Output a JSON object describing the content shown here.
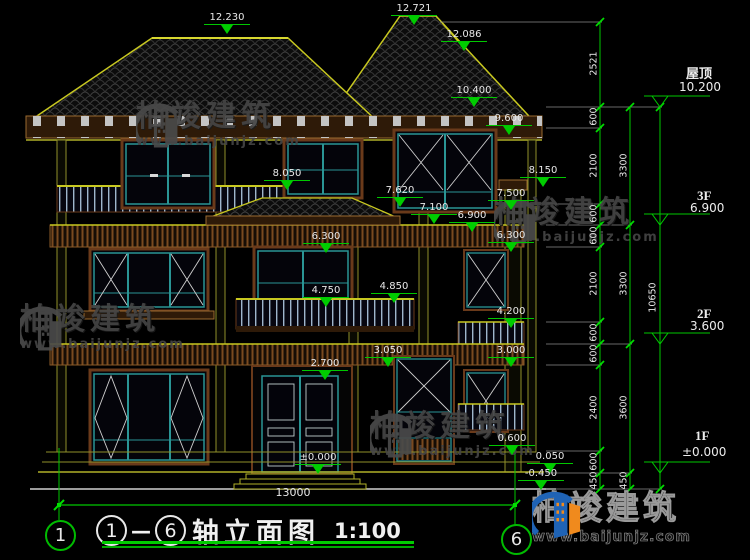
{
  "drawing_title": {
    "axis_from": "1",
    "dash": "—",
    "axis_to": "6",
    "title": "轴立面图",
    "scale": "1:100"
  },
  "axis_bubbles": {
    "left": "1",
    "right": "6"
  },
  "overall_dimension": "13000",
  "watermark": {
    "brand": "柏竣建筑",
    "url": "www.baijunjz.com"
  },
  "logo": {
    "brand": "柏竣建筑",
    "url": "www.baijunjz.com"
  },
  "floor_levels": [
    {
      "name": "屋顶",
      "elevation": "10.200",
      "x": 686,
      "y": 63,
      "ex": 679,
      "ey": 80
    },
    {
      "name": "3F",
      "elevation": "6.900",
      "x": 697,
      "y": 188,
      "ex": 690,
      "ey": 201
    },
    {
      "name": "2F",
      "elevation": "3.600",
      "x": 697,
      "y": 306,
      "ex": 690,
      "ey": 319
    },
    {
      "name": "1F",
      "elevation": "±0.000",
      "x": 695,
      "y": 428,
      "ex": 682,
      "ey": 445
    }
  ],
  "annotations": {
    "elevation_markers": [
      {
        "value": "12.230",
        "x": 204,
        "y": 12
      },
      {
        "value": "12.721",
        "x": 391,
        "y": 3
      },
      {
        "value": "12.086",
        "x": 441,
        "y": 29
      },
      {
        "value": "10.400",
        "x": 451,
        "y": 85
      },
      {
        "value": "9.600",
        "x": 486,
        "y": 113
      },
      {
        "value": "8.050",
        "x": 264,
        "y": 168
      },
      {
        "value": "8.150",
        "x": 520,
        "y": 165
      },
      {
        "value": "7.620",
        "x": 377,
        "y": 185
      },
      {
        "value": "7.500",
        "x": 488,
        "y": 188
      },
      {
        "value": "7.100",
        "x": 411,
        "y": 202
      },
      {
        "value": "6.900",
        "x": 449,
        "y": 210
      },
      {
        "value": "6.300",
        "x": 303,
        "y": 231
      },
      {
        "value": "6.300",
        "x": 488,
        "y": 230
      },
      {
        "value": "4.750",
        "x": 303,
        "y": 285
      },
      {
        "value": "4.850",
        "x": 371,
        "y": 281
      },
      {
        "value": "4.200",
        "x": 488,
        "y": 306
      },
      {
        "value": "3.050",
        "x": 365,
        "y": 345
      },
      {
        "value": "3.000",
        "x": 488,
        "y": 345
      },
      {
        "value": "2.700",
        "x": 302,
        "y": 358
      },
      {
        "value": "±0.000",
        "x": 295,
        "y": 452
      },
      {
        "value": "0.600",
        "x": 489,
        "y": 433
      },
      {
        "value": "0.050",
        "x": 527,
        "y": 451
      },
      {
        "value": "-0.450",
        "x": 518,
        "y": 468
      }
    ],
    "chain_labels": [
      {
        "value": "2521",
        "x": 594,
        "y": 64
      },
      {
        "value": "600",
        "x": 594,
        "y": 117
      },
      {
        "value": "2100",
        "x": 594,
        "y": 166
      },
      {
        "value": "600",
        "x": 594,
        "y": 214
      },
      {
        "value": "600",
        "x": 594,
        "y": 236
      },
      {
        "value": "2100",
        "x": 594,
        "y": 284
      },
      {
        "value": "600",
        "x": 594,
        "y": 333
      },
      {
        "value": "600",
        "x": 594,
        "y": 354
      },
      {
        "value": "2400",
        "x": 594,
        "y": 408
      },
      {
        "value": "600",
        "x": 594,
        "y": 462
      },
      {
        "value": "450",
        "x": 594,
        "y": 481
      },
      {
        "value": "3300",
        "x": 624,
        "y": 166
      },
      {
        "value": "3300",
        "x": 624,
        "y": 284
      },
      {
        "value": "3600",
        "x": 624,
        "y": 408
      },
      {
        "value": "450",
        "x": 624,
        "y": 481
      },
      {
        "value": "10650",
        "x": 653,
        "y": 298
      }
    ]
  },
  "colors": {
    "dimension_green": "#00c800",
    "outline_yellow": "#c8c820",
    "text_white": "#e8e8e8",
    "frame_teal": "#2a9595",
    "band_brown": "#8a5a28",
    "logo_blue": "#1f63b5",
    "logo_orange": "#f08a1d"
  }
}
